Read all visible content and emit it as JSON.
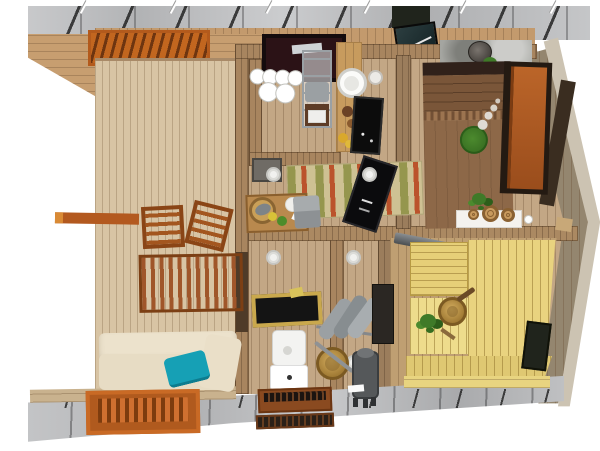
{
  "scene": {
    "type": "3d-floorplan-top-view",
    "rooms": [
      "deck-terrace",
      "kitchen",
      "living-dining",
      "bedroom",
      "bathroom",
      "washroom",
      "sauna"
    ],
    "inventory": [
      "roof-foundation-strip",
      "roof-rafters",
      "roof-pins",
      "wood-fascia",
      "pergola-slats",
      "deck-floor",
      "interior-floor",
      "sauna-floor",
      "paver-walkway",
      "perimeter-wall-right",
      "timber-beam",
      "deck-chair",
      "deck-chair",
      "deck-slat-platform",
      "daybed",
      "teal-pillow",
      "fire-grate",
      "kitchen-stove-counter",
      "dish-rack",
      "metal-shelf",
      "kitchen-counter",
      "sink",
      "cooktop",
      "striped-rug",
      "tv-panel",
      "ceiling-light",
      "dining-table",
      "fish-pan",
      "dinner-plate",
      "seat-cushion",
      "stone-ledge",
      "flower-pot",
      "green-plant",
      "double-bed",
      "bed-plant-decor",
      "entry-door",
      "dresser",
      "wood-disc",
      "towel-rail",
      "towel",
      "wash-bucket",
      "water-heater",
      "shower-tray",
      "toilet",
      "door-mat",
      "sauna-bench",
      "sauna-bucket",
      "birch-whisk",
      "sauna-stove",
      "chimney-pipe",
      "sauna-window",
      "solar-panel"
    ]
  },
  "colors": {
    "concrete_gray": "#bfc0c2",
    "deck_wood": "#d8c4a4",
    "interior_wood": "#c3a785",
    "sauna_floor": "#bf9f72",
    "wall_wood": "#a8855f",
    "wall_wood_dark": "#9b7d5c",
    "wall_mid": "#ab8962",
    "right_wall": "#94866f",
    "fascia_wood": "#ccc3b2",
    "roof_fascia": "#c79e70",
    "top_plate": "#c39a6d",
    "pergola_orange": "#b3591c",
    "timber_orange": "#b3591f",
    "fire_grate_orange": "#b05a1e",
    "door_orange": "#a8551f",
    "cream_cushion": "#ece2cc",
    "cream_cushion_dark": "#e7dcc4",
    "teal_pillow": "#16a0b5",
    "rug_base": "#cec193",
    "rug_green": "#a9a45d",
    "rug_red": "#c05b32",
    "tv_black": "#0b0b0d",
    "table_wood": "#b9894e",
    "cushion_gray": "#8d9194",
    "stone_ledge": "#a4a5a0",
    "bed_header": "#30211a",
    "bed_wood": "#7a5639",
    "bed_stitch": "#9c7450",
    "bed_spread": "#8d6848",
    "plant_green": "#3f7a28",
    "dresser_white": "#f4f2ee",
    "disc_wood": "#c89a5e",
    "metal_gray": "#9aa0a4",
    "towel_gray": "#9ba0a3",
    "bucket_wood": "#b98c46",
    "toilet_white": "#f3f3f1",
    "shower_black": "#141414",
    "shower_frame": "#c9a84d",
    "heater_gray": "#55585a",
    "mat_brown": "#8a4a20",
    "mat_black": "#2a2018",
    "sauna_bench": "#e9d37f",
    "sauna_bench_light": "#eedc8c",
    "sauna_bench_deep": "#e6cf78",
    "sauna_bench_front": "#dfc872",
    "window_dark": "#20241c",
    "stove_black": "#2b1216",
    "cooktop_black": "#0c0c0c",
    "sink_white": "#fbfbf9",
    "pipe_gray": "#6e7275",
    "dark_band": "#3a2d20"
  }
}
